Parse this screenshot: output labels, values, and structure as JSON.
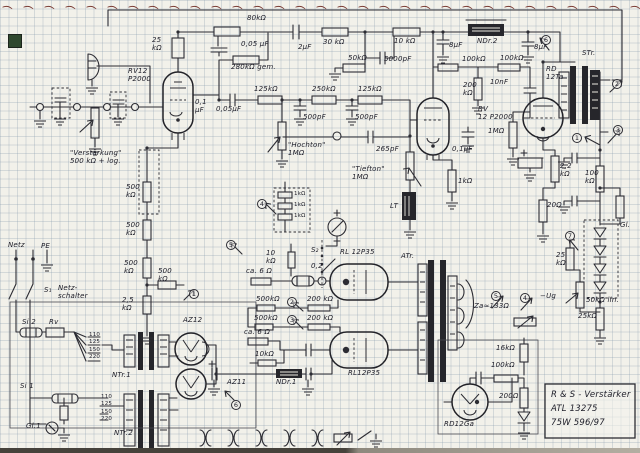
{
  "document": {
    "kind": "hand-drawn vacuum-tube amplifier schematic on graph paper",
    "binding": "spiral"
  },
  "title_block": {
    "line1": "R & S - Verstärker",
    "line2": "ATL 13275",
    "line3": "75W   596/97"
  },
  "labels": {
    "rv12_1": "RV12\nP2000",
    "r25k": "25\nkΩ",
    "verst": "\"Verstärkung\"\n500 kΩ + log.",
    "c01_v1": "0,1\nμF",
    "r80k": "80kΩ",
    "c005_1": "0,05 μF",
    "c2u": "2μF",
    "r30k": "30 kΩ",
    "r10k1": "10 kΩ",
    "r280k": "280kΩ gem.",
    "r50k1": "50kΩ",
    "c5000": "5000pF",
    "r125": "125kΩ",
    "c005_2": "0,05μF",
    "r250k": "250kΩ",
    "c500": "500pF",
    "hochton": "\"Hochton\"\n1MΩ",
    "c265": "265pF",
    "tiefton": "\"Tiefton\"\n1MΩ",
    "lt": "LT",
    "r1k1": "1kΩ",
    "c8": "8μF",
    "ndr2": "NDr.2",
    "r100k": "100kΩ",
    "r200k1": "200\nkΩ",
    "c10n": "10nF",
    "rv12_2": "RV\n12 P2000",
    "rd12ta": "RD\n12Ta",
    "str": "STr.",
    "r1m": "1MΩ",
    "c01_2": "0,1μF",
    "r22k": "2,2\nkΩ",
    "r100k3": "100\nkΩ",
    "r20": "20Ω",
    "r500kv": "500\nkΩ",
    "r25_2": "2,5\nkΩ",
    "netz": "Netz",
    "pe": "PE",
    "s1": "S₁",
    "netzschalter": "Netz-\nschalter",
    "si2": "Si 2",
    "rv": "Rv",
    "si1": "Si 1",
    "gl1": "Gl.1",
    "ntr1": "NTr.1",
    "ntr2": "NTr.2",
    "az12": "AZ12",
    "az11": "AZ11",
    "taps": "110\n125\n150\n220",
    "r10k2": "10\nkΩ",
    "s2": "S₂",
    "a02": "0,2",
    "rl12_1": "RL 12P35",
    "atr": "ATr.",
    "ca6": "ca. 6 Ω",
    "r500kh": "500kΩ",
    "r200kh": "200 kΩ",
    "r10k3": "10kΩ",
    "ndr1": "NDr.1",
    "rl12_2": "RL12P35",
    "r1k_lad": "1kΩ",
    "za": "Za≈133Ω",
    "r25k3": "25\nkΩ",
    "ug": "−Ug",
    "r50klin": "50kΩ lin.",
    "r25k4": "25kΩ",
    "gl": "Gl.",
    "r16k": "16kΩ",
    "r100k4": "100kΩ",
    "r200o": "200Ω",
    "rd12ga": "RD12Ga"
  },
  "terminals": {
    "t1": "1",
    "t2": "2",
    "t3": "3",
    "t4": "4",
    "t5": "5",
    "t6": "6",
    "t7": "7"
  },
  "colors": {
    "ink": "#2c2c33",
    "paper": "#f2f1ea",
    "grid": "#aebcc9",
    "spiral": "#7a3b33",
    "sticker": "#30492f"
  }
}
